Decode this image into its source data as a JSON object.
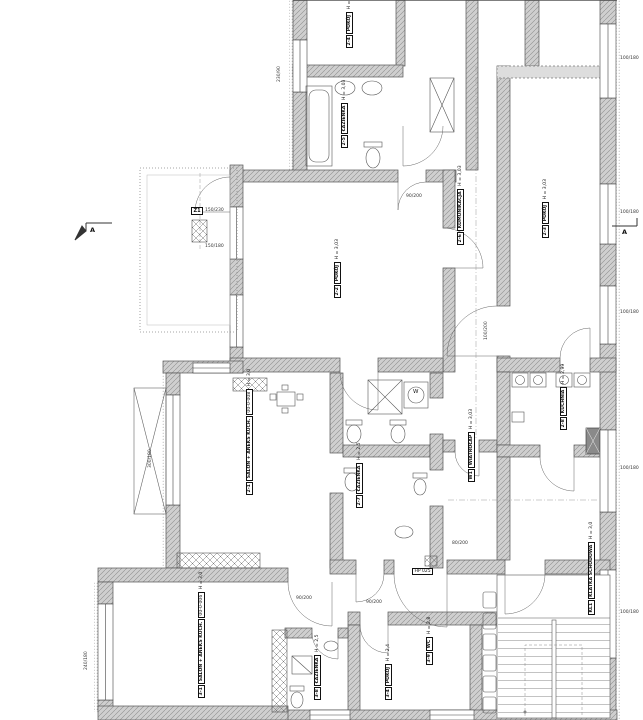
{
  "markers": {
    "section_left": "A",
    "section_right": "A",
    "zone": "Z1",
    "hp": "HP 025",
    "washer": "W"
  },
  "rooms": [
    {
      "tag": "2-4",
      "name": "POKÓJ",
      "height": "H = 3,03"
    },
    {
      "tag": "2-5",
      "name": "ŁAZIENKA",
      "height": "H = 3,03"
    },
    {
      "tag": "2-6",
      "name": "KOMUNIKACJA",
      "height": "H = 3,03"
    },
    {
      "tag": "2-2",
      "name": "POKÓJ",
      "height": "H = 3,03"
    },
    {
      "tag": "2-3",
      "name": "POKÓJ",
      "height": "H = 3,03"
    },
    {
      "tag": "2-1",
      "name": "SALON + ANEKS KUCH.",
      "code": "00-0-008",
      "height": "H = 3,0"
    },
    {
      "tag": "2-7",
      "name": "ŁAZIENKA",
      "height": "H = 2,5"
    },
    {
      "tag": "W1",
      "name": "WIATROŁAP",
      "height": "H = 3,03"
    },
    {
      "tag": "2-8",
      "name": "KUCHNIA",
      "height": "H = 2,99"
    },
    {
      "tag": "3-1",
      "name": "SALON + ANEKS KUCH.",
      "code": "00-0-006",
      "height": "H = 3,0"
    },
    {
      "tag": "3-4",
      "name": "POKÓJ",
      "height": "H = 2,4"
    },
    {
      "tag": "3-8",
      "name": "ŁAZIENKA",
      "height": "H = 2,5"
    },
    {
      "tag": "3-9",
      "name": "WC",
      "height": "H = 2,8"
    },
    {
      "tag": "KL1",
      "name": "KLATKA SCHODOWA",
      "height": "H = 3,0"
    }
  ],
  "dims": [
    "230/90",
    "150/230",
    "150/180",
    "300/180",
    "240/180",
    "100/180",
    "100/180",
    "100/180",
    "100/180",
    "100/180",
    "90/200",
    "80/200",
    "90/200",
    "100/200",
    "90/200"
  ],
  "colors": {
    "wall_fill": "#cfcfcf",
    "line": "#444",
    "dash": "#999"
  }
}
